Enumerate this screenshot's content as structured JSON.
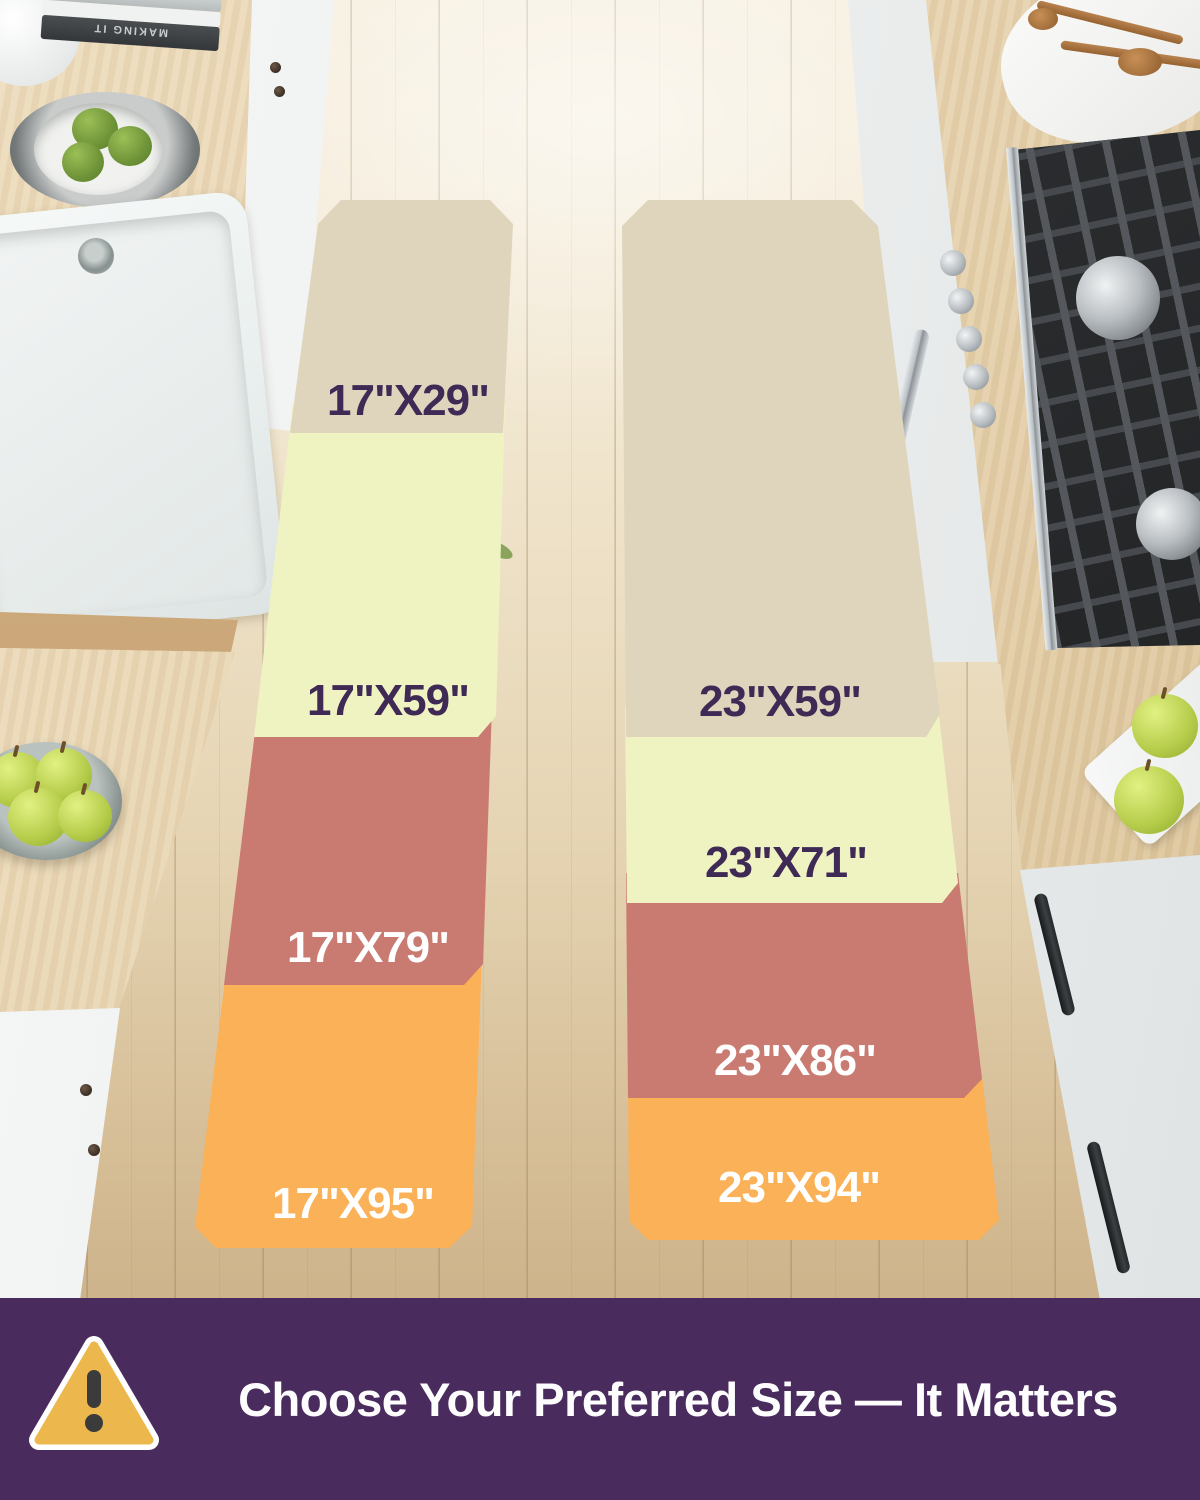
{
  "runners": [
    {
      "name": "17 inch wide runner",
      "segments": [
        {
          "size": "17\"X29\"",
          "color": "#ded5bc",
          "label_color": "#3f2a56"
        },
        {
          "size": "17\"X59\"",
          "color": "#eff3c2",
          "label_color": "#3f2a56"
        },
        {
          "size": "17\"X79\"",
          "color": "#c97b72",
          "label_color": "#ffffff"
        },
        {
          "size": "17\"X95\"",
          "color": "#fbb157",
          "label_color": "#ffffff"
        }
      ]
    },
    {
      "name": "23 inch wide runner",
      "segments": [
        {
          "size": "23\"X59\"",
          "color": "#ded5bc",
          "label_color": "#3f2a56"
        },
        {
          "size": "23\"X71\"",
          "color": "#eff3c2",
          "label_color": "#3f2a56"
        },
        {
          "size": "23\"X86\"",
          "color": "#c97b72",
          "label_color": "#ffffff"
        },
        {
          "size": "23\"X94\"",
          "color": "#fbb157",
          "label_color": "#ffffff"
        }
      ]
    }
  ],
  "banner": {
    "text": "Choose Your Preferred Size — It Matters",
    "background_color": "#4a2b5e",
    "text_color": "#ffffff",
    "icon": "warning-triangle-icon",
    "icon_fill": "#ecb84d"
  },
  "decor": {
    "book_spine_text": "MAKING IT"
  }
}
